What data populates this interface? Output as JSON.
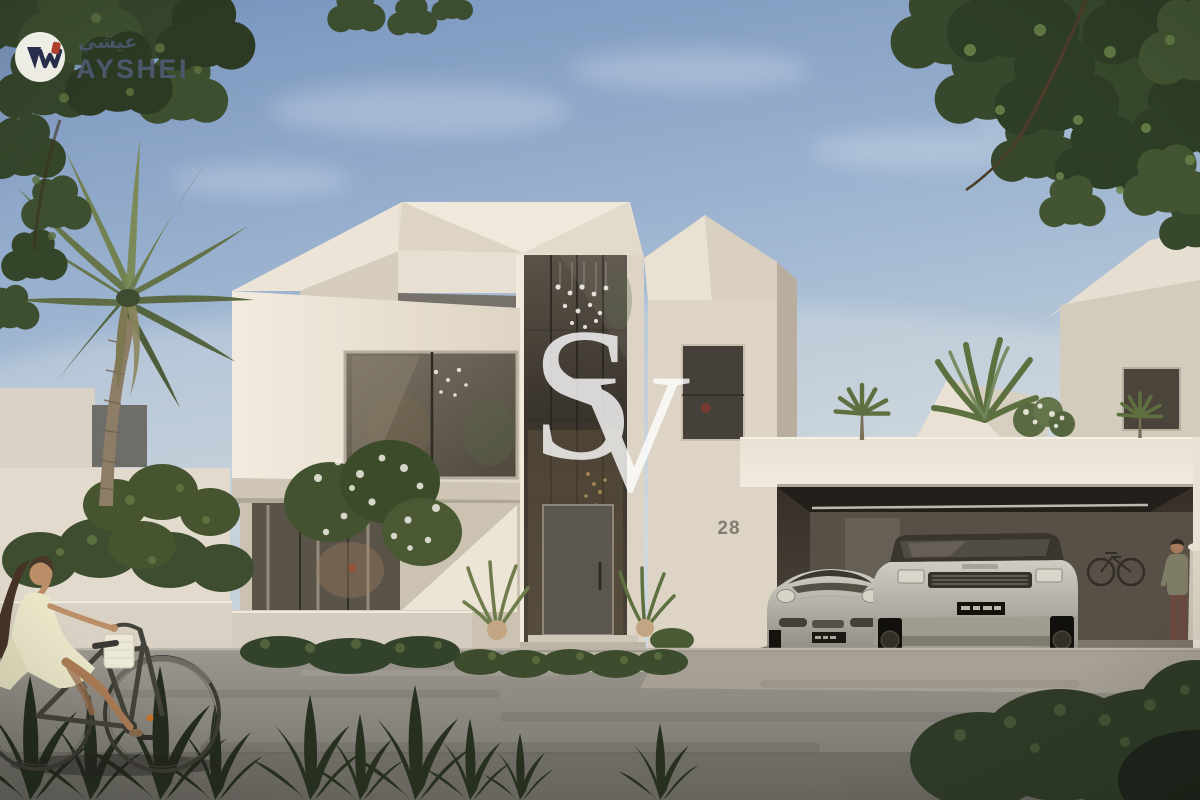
{
  "image": {
    "kind": "3D architectural rendering used as a real-estate listing photo",
    "subject": "Modern cubist two-storey villa with central glass entry tower, attached carport with two cars, palm trees and desert landscaping; woman cycling past on the road, man standing in the carport"
  },
  "branding": {
    "logo_name": "AYSHEI",
    "logo_name_arabic": "عيشي",
    "wordmark_color": "#4d5a70",
    "badge_bg": "#f7f5ef",
    "mark_color": "#272c4e",
    "mark_accent": "#b6402f"
  },
  "watermark": {
    "letters": [
      "S",
      "V"
    ],
    "color": "#ffffff"
  },
  "property": {
    "house_number": "28",
    "house_number_color": "#837c70"
  },
  "palette": {
    "sky_top": "#7793bd",
    "sky_horizon": "#d5dce0",
    "wall_light": "#efe8db",
    "wall_shadow": "#c9c0af",
    "roof_dark": "#76716a",
    "glass": "#423c34",
    "road": "#8b8882",
    "foliage_dark": "#33422a",
    "foliage_light": "#6d8049",
    "car_silver": "#c2bfb7"
  },
  "scene_objects": [
    "villa",
    "glass-entry-tower",
    "carport",
    "porsche-911",
    "range-rover",
    "wall-mounted-bicycle",
    "man-standing",
    "woman-on-bicycle",
    "palm-tree",
    "street-trees",
    "hedges",
    "road"
  ]
}
